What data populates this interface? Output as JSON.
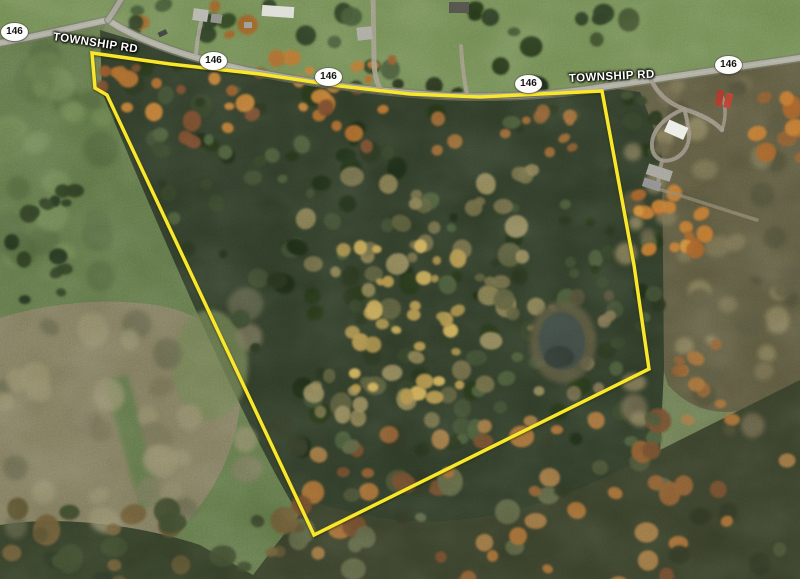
{
  "map": {
    "kind": "satellite-aerial-view",
    "overlay": "property-boundary-outline",
    "season": "autumn"
  },
  "road_labels": [
    {
      "text": "TOWNSHIP RD"
    },
    {
      "text": "TOWNSHIP RD"
    }
  ],
  "route_shields": [
    {
      "label": "146"
    },
    {
      "label": "146"
    },
    {
      "label": "146"
    },
    {
      "label": "146"
    },
    {
      "label": "146"
    }
  ],
  "boundary": {
    "stroke_color": "#f8e72b",
    "points": "92,53 170,64 260,74 340,86 410,94 480,97 540,94 602,91 634,265 649,369 314,535 107,95 95,88"
  },
  "features": {
    "pond": "pond",
    "main_road": "paved township road",
    "driveways": "gravel driveways",
    "buildings": [
      "house",
      "house",
      "mobile-home",
      "shed",
      "house",
      "outbuilding",
      "white-barn",
      "gray-outbuilding",
      "gray-outbuilding",
      "red-trailer",
      "red-trailer",
      "parked-car"
    ]
  },
  "palette": {
    "boundary_yellow": "#f8e72b",
    "road_gray": "#a8a89c",
    "field_green": "#5e7446",
    "forest_dark": "#2d3926",
    "meadow_tan": "#7e795c",
    "autumn_orange": "#b5722e",
    "pond_water": "#3b463f",
    "shield_white": "#fcfcfa"
  }
}
